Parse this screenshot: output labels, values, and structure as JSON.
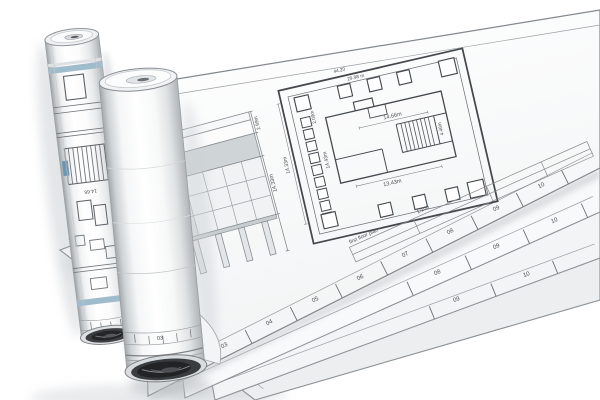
{
  "plan": {
    "note_line1": "44.20",
    "note_line2": "29.98 m",
    "dim_left_outer": "14.33m",
    "dim_left_inner": "14.43m",
    "dim_top_left": "2.09m",
    "dim_stairs": "14.66m",
    "dim_stairs_side": "4.46m",
    "dim_bottom": "13.43m"
  },
  "elevation": {
    "dim_top": "2.99m",
    "dim_right": "14.33m",
    "dim_base": "3.35m"
  },
  "titleblock": {
    "drawing_title": "first floor plan",
    "scale": "1/100"
  },
  "rulers": {
    "top_sheet": [
      "03",
      "04",
      "05",
      "06",
      "07",
      "08",
      "09",
      "10"
    ],
    "second_sheet": [
      "08",
      "09",
      "10"
    ],
    "third_sheet": [
      "09",
      "10"
    ],
    "bottom_sheet_corner": "13",
    "big_roll": "03",
    "left_roll": "04"
  },
  "roll_left": {
    "section_label": "14.66"
  },
  "colors": {
    "accent_blue": "#9fbccd",
    "tag_blue": "#6f96b1",
    "line_dark": "#44484c",
    "paper_white": "#ffffff",
    "shadow_gray": "#ccd1d5"
  }
}
